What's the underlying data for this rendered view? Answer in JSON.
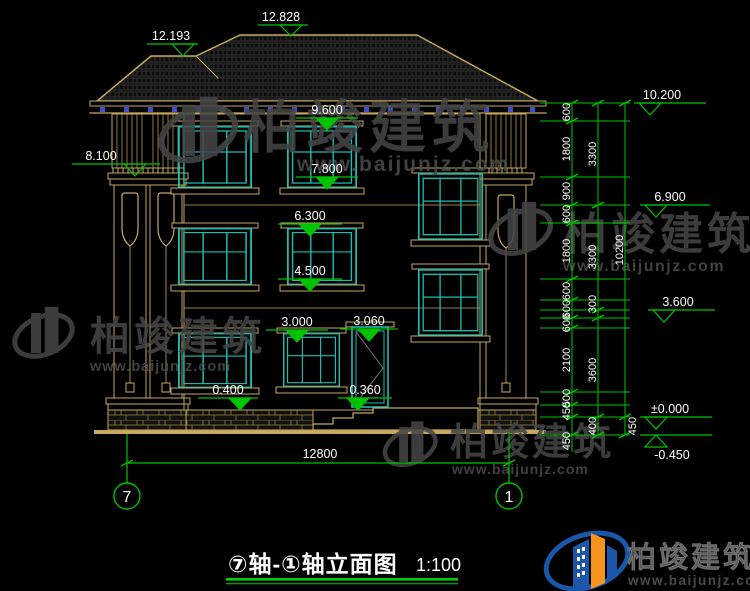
{
  "brand": {
    "name": "柏竣建筑",
    "url": "www.baijunjz.com"
  },
  "title": {
    "name": "⑦轴-①轴立面图",
    "scale": "1:100"
  },
  "axes": {
    "left": "7",
    "right": "1"
  },
  "levels": {
    "ridge_left": "12.193",
    "ridge": "12.828",
    "col_top": "8.100",
    "eave": "10.200",
    "w3_top": "9.600",
    "w3_sill": "7.800",
    "f3": "6.900",
    "w2_top": "6.300",
    "w2_sill": "4.500",
    "f2": "3.600",
    "w1_top": "3.000",
    "door_top": "3.060",
    "plinth": "0.400",
    "door_sill": "0.360",
    "zero": "±0.000",
    "site": "-0.450"
  },
  "dims": {
    "width": "12800",
    "chain1": [
      "600",
      "1800",
      "900",
      "600",
      "1800",
      "600",
      "600",
      "600",
      "2100",
      "500",
      "450",
      "450"
    ],
    "chain2": [
      "3300",
      "3300",
      "300",
      "3600",
      "400"
    ],
    "chain3": [
      "10200",
      "450"
    ]
  }
}
